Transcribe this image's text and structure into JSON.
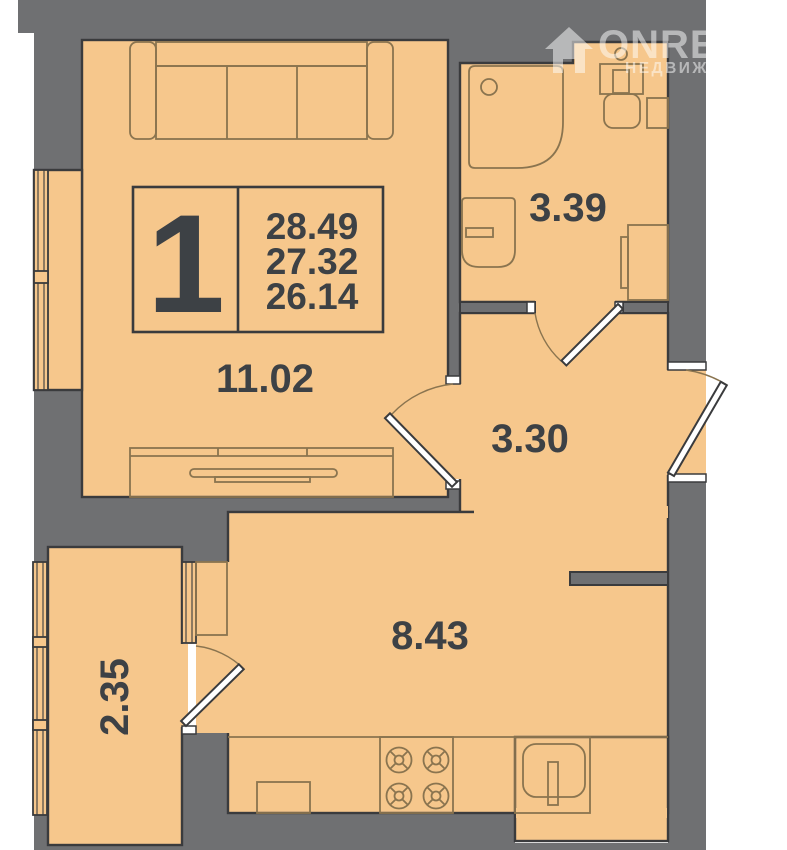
{
  "watermark": {
    "brand": "ONREALT",
    "subtitle": "НЕДВИЖИМОСТЬ"
  },
  "unit_card": {
    "room_count": "1",
    "area_lines": [
      "28.49",
      "27.32",
      "26.14"
    ]
  },
  "rooms": {
    "living_area": "11.02",
    "bathroom_area": "3.39",
    "hall_area": "3.30",
    "kitchen_area": "8.43",
    "balcony_area": "2.35"
  },
  "colors": {
    "floor": "#F6C78C",
    "wall": "#6F7072",
    "outline": "#3A3B3D",
    "furniture_line": "#8A744F",
    "label_text": "#3D4145",
    "background": "#FFFFFF"
  }
}
